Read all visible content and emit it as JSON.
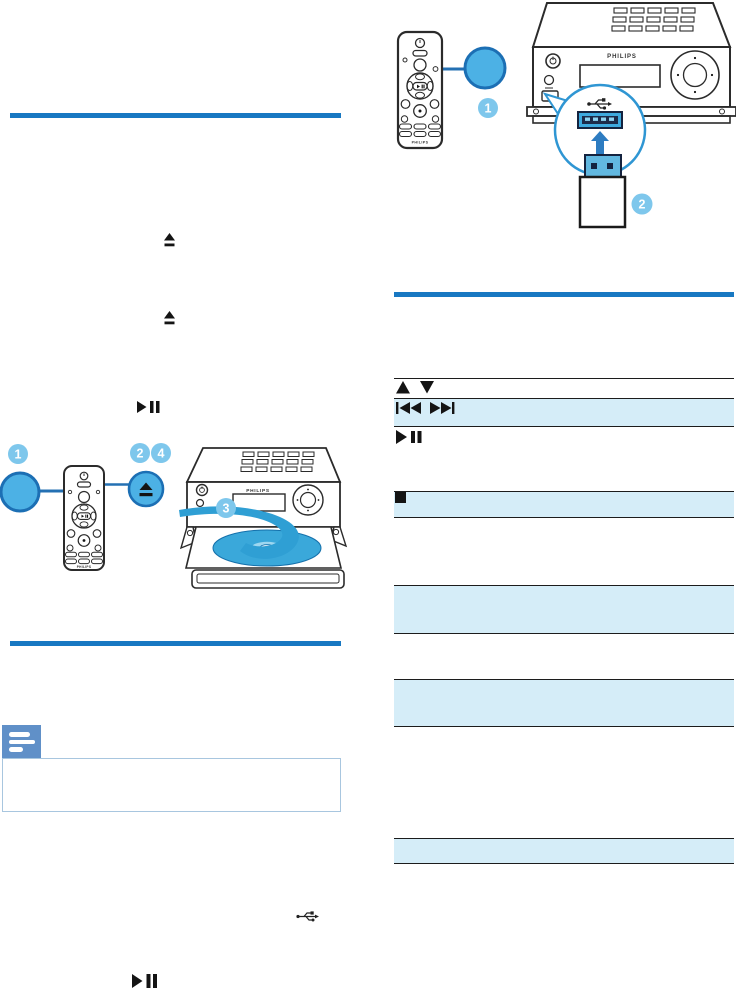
{
  "brand": "PHILIPS",
  "colors": {
    "divider_blue": "#1878c2",
    "table_row_highlight": "#d5edf8",
    "table_line": "#1c1c1c",
    "callout_fill": "#7ec7ec",
    "magnified_button_fill": "#4cb1e5",
    "magnified_button_stroke": "#1c6fb4",
    "connector_line": "#2470b3",
    "note_icon_blue": "#6090c8",
    "note_box_border": "#a8c6df",
    "usb_socket_blue": "#3ea9de",
    "usb_slot_navy": "#1c2b4a",
    "arrow_blue": "#2d7cc1",
    "disc_blue": "#3aa8da",
    "swoosh_blue": "#2f9fd4"
  },
  "usb_diagram": {
    "description": "remote control pointing to magnified button; mini hi-fi system with magnified USB socket and USB stick being inserted",
    "callout_button": "1",
    "callout_usb": "2",
    "icons": [
      "remote-control",
      "magnified-button",
      "usb-symbol",
      "usb-socket",
      "up-arrow",
      "usb-stick"
    ]
  },
  "cd_diagram": {
    "description": "remote control with magnified button and magnified eject button; mini hi-fi system with open disc tray and disc",
    "callout_button": "1",
    "callout_eject_a": "2",
    "callout_eject_b": "4",
    "callout_disc": "3",
    "icons": [
      "remote-control",
      "magnified-button",
      "eject-button",
      "disc",
      "swoosh-arrow"
    ]
  },
  "left_column": {
    "inline_icons": [
      "eject",
      "eject",
      "play-pause",
      "usb-symbol",
      "play-pause"
    ],
    "note_box": {
      "icon": "note-icon",
      "text": ""
    }
  },
  "controls_table": {
    "rows": [
      {
        "icons": [
          "up",
          "down"
        ],
        "highlighted": false
      },
      {
        "icons": [
          "previous",
          "next"
        ],
        "highlighted": true
      },
      {
        "icons": [
          "play-pause"
        ],
        "highlighted": false
      },
      {
        "icons": [
          "stop"
        ],
        "highlighted": true
      },
      {
        "icons": [],
        "highlighted": true
      },
      {
        "icons": [],
        "highlighted": true
      },
      {
        "icons": [],
        "highlighted": true
      }
    ]
  }
}
